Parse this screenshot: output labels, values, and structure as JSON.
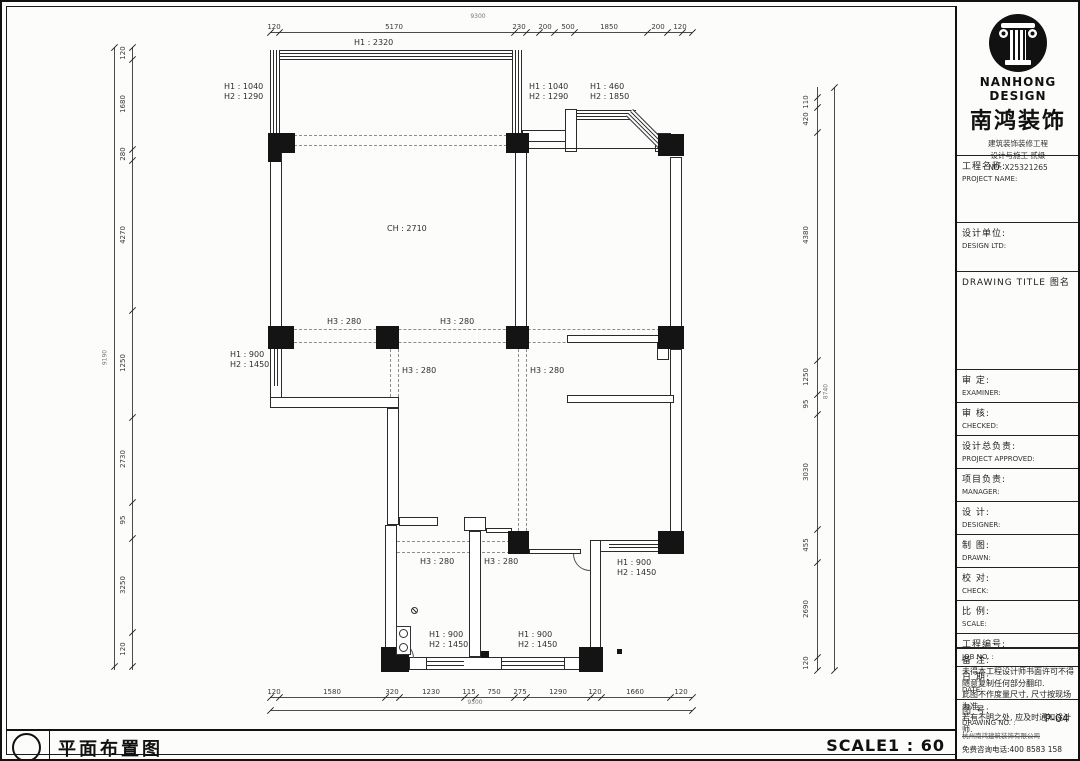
{
  "titlebar": {
    "title": "平面布置图",
    "scale": "SCALE1 : 60"
  },
  "title_block": {
    "brand_en": "NANHONG DESIGN",
    "brand_cn": "南鸿装饰",
    "credentials": [
      "建筑装饰装修工程",
      "设计与施工 贰级",
      "NO: X25321265"
    ],
    "fields": [
      {
        "cn": "工程名称:",
        "en": "PROJECT NAME:"
      },
      {
        "cn": "设计单位:",
        "en": "DESIGN LTD:"
      },
      {
        "cn": "DRAWING TITLE  图名",
        "en": ""
      },
      {
        "cn": "审  定:",
        "en": "EXAMINER:"
      },
      {
        "cn": "审  核:",
        "en": "CHECKED:"
      },
      {
        "cn": "设计总负责:",
        "en": "PROJECT APPROVED:"
      },
      {
        "cn": "项目负责:",
        "en": "MANAGER:"
      },
      {
        "cn": "设  计:",
        "en": "DESIGNER:"
      },
      {
        "cn": "制  图:",
        "en": "DRAWN:"
      },
      {
        "cn": "校  对:",
        "en": "CHECK:"
      },
      {
        "cn": "比  例:",
        "en": "SCALE:"
      },
      {
        "cn": "工程编号:",
        "en": "JOB NO. :"
      },
      {
        "cn": "日  期:",
        "en": "DATE:"
      },
      {
        "cn": "图  号:",
        "en": "DRAWING NO. :",
        "value": "P-04"
      }
    ],
    "notes_title": "备  注:",
    "notes": [
      "未得本工程设计师书面许可不得",
      "随意复制任何部分翻印.",
      "此图不作度量尺寸, 尺寸按现场",
      "为准.",
      "若有不明之处, 应及时通知设计",
      "师."
    ],
    "footer_company": "杭州南鸿建筑装饰有限公司",
    "footer_phone": "免费咨询电话:400 8583 158"
  },
  "plan_labels": [
    [
      352,
      36,
      "H1 : 2320"
    ],
    [
      222,
      80,
      "H1 : 1040\nH2 : 1290"
    ],
    [
      527,
      80,
      "H1 : 1040\nH2 : 1290"
    ],
    [
      588,
      80,
      "H1 : 460\nH2 : 1850"
    ],
    [
      385,
      222,
      "CH : 2710"
    ],
    [
      325,
      315,
      "H3 : 280"
    ],
    [
      438,
      315,
      "H3 : 280"
    ],
    [
      228,
      348,
      "H1 : 900\nH2 : 1450"
    ],
    [
      400,
      364,
      "H3 : 280"
    ],
    [
      528,
      364,
      "H3 : 280"
    ],
    [
      615,
      556,
      "H1 : 900\nH2 : 1450"
    ],
    [
      418,
      555,
      "H3 : 280"
    ],
    [
      482,
      555,
      "H3 : 280"
    ],
    [
      427,
      628,
      "H1 : 900\nH2 : 1450"
    ],
    [
      516,
      628,
      "H1 : 900\nH2 : 1450"
    ]
  ],
  "dims": {
    "top": {
      "line": [
        268,
        30,
        422
      ],
      "ticks": [
        268,
        277,
        512,
        524,
        537,
        552,
        572,
        645,
        665,
        680,
        690
      ],
      "labels": [
        [
          272,
          "120"
        ],
        [
          392,
          "5170"
        ],
        [
          517,
          "230"
        ],
        [
          543,
          "200"
        ],
        [
          566,
          "500"
        ],
        [
          607,
          "1850"
        ],
        [
          656,
          "200"
        ],
        [
          678,
          "120"
        ]
      ],
      "total": [
        476,
        11,
        "9300"
      ]
    },
    "bottom": {
      "line": [
        268,
        695,
        422
      ],
      "line2": [
        268,
        708,
        422
      ],
      "ticks": [
        268,
        277,
        383,
        397,
        462,
        473,
        512,
        524,
        588,
        599,
        668,
        690
      ],
      "ticks2": [
        268,
        690
      ],
      "labels": [
        [
          272,
          "120"
        ],
        [
          330,
          "1580"
        ],
        [
          390,
          "320"
        ],
        [
          429,
          "1230"
        ],
        [
          467,
          "115"
        ],
        [
          492,
          "750"
        ],
        [
          518,
          "275"
        ],
        [
          556,
          "1290"
        ],
        [
          593,
          "120"
        ],
        [
          633,
          "1660"
        ],
        [
          679,
          "120"
        ]
      ],
      "total": [
        473,
        697,
        "9300"
      ]
    },
    "left": {
      "line": [
        130,
        45,
        623
      ],
      "line2": [
        112,
        45,
        623
      ],
      "ticks": [
        45,
        57,
        147,
        158,
        308,
        415,
        500,
        536,
        630,
        664
      ],
      "ticks2": [
        45,
        664
      ],
      "labels": [
        [
          51,
          "120"
        ],
        [
          102,
          "1680"
        ],
        [
          152,
          "280"
        ],
        [
          233,
          "4270"
        ],
        [
          361,
          "1250"
        ],
        [
          457,
          "2730"
        ],
        [
          518,
          "95"
        ],
        [
          583,
          "3250"
        ],
        [
          647,
          "120"
        ]
      ],
      "lx": 121,
      "total": [
        103,
        356,
        "9190"
      ]
    },
    "right": {
      "line": [
        815,
        85,
        583
      ],
      "line2": [
        832,
        85,
        583
      ],
      "ticks": [
        95,
        105,
        130,
        358,
        392,
        412,
        527,
        560,
        655,
        668
      ],
      "ticks2": [
        85,
        668
      ],
      "labels": [
        [
          100,
          "110"
        ],
        [
          117,
          "420"
        ],
        [
          233,
          "4380"
        ],
        [
          375,
          "1250"
        ],
        [
          402,
          "95"
        ],
        [
          470,
          "3030"
        ],
        [
          543,
          "455"
        ],
        [
          607,
          "2690"
        ],
        [
          661,
          "120"
        ]
      ],
      "lx": 804,
      "total": [
        824,
        390,
        "8740"
      ]
    }
  },
  "geometry": {
    "walls": [
      [
        513,
        150,
        12,
        176
      ],
      [
        668,
        155,
        12,
        170
      ],
      [
        668,
        347,
        12,
        183
      ],
      [
        268,
        150,
        12,
        175
      ],
      [
        268,
        382,
        12,
        15
      ],
      [
        268,
        395,
        129,
        11
      ],
      [
        385,
        406,
        12,
        117
      ],
      [
        397,
        515,
        39,
        9
      ],
      [
        383,
        523,
        12,
        124
      ],
      [
        462,
        515,
        22,
        14
      ],
      [
        467,
        529,
        12,
        126
      ],
      [
        588,
        538,
        11,
        117
      ],
      [
        598,
        538,
        70,
        12
      ],
      [
        383,
        655,
        217,
        13
      ],
      [
        565,
        333,
        95,
        8
      ],
      [
        565,
        393,
        107,
        8
      ],
      [
        655,
        341,
        12,
        17
      ],
      [
        520,
        128,
        45,
        12
      ],
      [
        563,
        107,
        12,
        43
      ],
      [
        653,
        131,
        16,
        19
      ],
      [
        407,
        655,
        18,
        13
      ],
      [
        460,
        655,
        40,
        13
      ],
      [
        562,
        655,
        18,
        13
      ],
      [
        655,
        538,
        13,
        12
      ],
      [
        484,
        526,
        26,
        5
      ],
      [
        527,
        547,
        52,
        5
      ]
    ],
    "winh": [
      [
        268,
        48,
        252,
        10
      ],
      [
        575,
        108,
        59,
        10
      ],
      [
        607,
        538,
        50,
        12
      ],
      [
        425,
        655,
        37,
        13
      ],
      [
        500,
        655,
        62,
        13
      ]
    ],
    "winv": [
      [
        268,
        48,
        10,
        92
      ],
      [
        510,
        48,
        10,
        84
      ],
      [
        268,
        347,
        12,
        37
      ]
    ],
    "wind": [
      [
        631,
        107,
        47,
        10,
        45
      ]
    ],
    "lines": [
      [
        523,
        146,
        150,
        1
      ],
      [
        337,
        48,
        1,
        10
      ],
      [
        460,
        48,
        1,
        10
      ]
    ],
    "cols": [
      [
        266,
        131,
        27,
        20
      ],
      [
        266,
        149,
        13,
        11
      ],
      [
        504,
        131,
        23,
        20
      ],
      [
        656,
        132,
        26,
        22
      ],
      [
        266,
        324,
        26,
        23
      ],
      [
        374,
        324,
        23,
        23
      ],
      [
        504,
        324,
        23,
        23
      ],
      [
        656,
        324,
        26,
        23
      ],
      [
        506,
        529,
        21,
        23
      ],
      [
        656,
        529,
        26,
        23
      ],
      [
        379,
        645,
        28,
        25
      ],
      [
        577,
        645,
        24,
        25
      ],
      [
        479,
        649,
        8,
        7
      ],
      [
        615,
        647,
        5,
        5
      ]
    ],
    "dashh": [
      [
        292,
        133,
        213
      ],
      [
        292,
        143,
        213
      ],
      [
        292,
        327,
        366
      ],
      [
        292,
        340,
        366
      ],
      [
        385,
        539,
        133
      ],
      [
        385,
        550,
        133
      ]
    ],
    "dashv": [
      [
        388,
        347,
        168
      ],
      [
        396,
        347,
        168
      ],
      [
        516,
        347,
        182
      ],
      [
        524,
        347,
        182
      ]
    ],
    "arcs": [
      [
        571,
        552,
        17,
        "bl"
      ],
      [
        396,
        640,
        16,
        "tr"
      ]
    ],
    "washer": [
      394,
      624,
      15,
      29
    ],
    "drain": [
      409,
      605
    ]
  }
}
